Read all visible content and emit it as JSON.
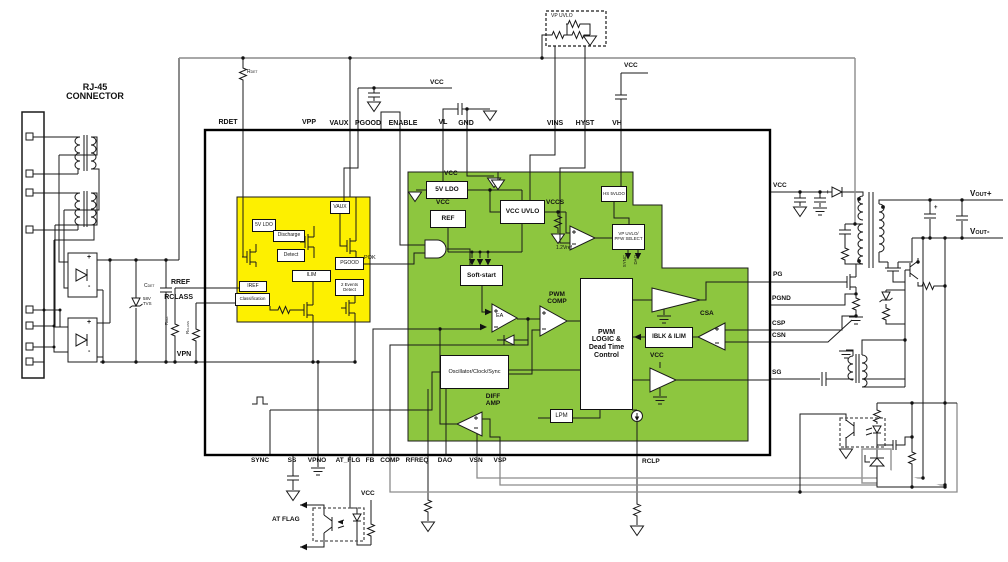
{
  "sym": {
    "plus": "+",
    "minus": "-"
  },
  "colors": {
    "yellow": "#fdf000",
    "green": "#8dc63f",
    "wire": "#1a1a1a",
    "gray_net": "#8c8c8c"
  },
  "rj45": {
    "line1": "RJ-45",
    "line2": "CONNECTOR"
  },
  "parts": {
    "rdet": {
      "base": "R",
      "sub": "DET"
    },
    "cdet": {
      "base": "C",
      "sub": "DET"
    },
    "tvs": {
      "line1": "58V",
      "line2": "TVS"
    },
    "rref": {
      "base": "R",
      "sub": "REF"
    },
    "rclass": {
      "base": "R",
      "sub": "CLASS"
    }
  },
  "nets": {
    "rref": "RREF",
    "rclass": "RCLASS",
    "vpn": "VPN",
    "pok": "POK",
    "vcc": "VCC",
    "vp_uvlo": "VP UVLO",
    "at_flag": "AT FLAG"
  },
  "ic": {
    "top_pins": [
      "RDET",
      "VPP",
      "VAUX",
      "PGOOD",
      "ENABLE",
      "VL",
      "GND",
      "VINS",
      "HYST",
      "VH"
    ],
    "bottom_pins": [
      "SYNC",
      "SS",
      "VPNO",
      "AT_FLG",
      "FB",
      "COMP",
      "RFREQ",
      "DAO",
      "VSN",
      "VSP"
    ],
    "right_pins": [
      "VCC",
      "PG",
      "PGND",
      "CSP",
      "CSN",
      "SG"
    ],
    "corner_pin": "RCLP"
  },
  "yellow": {
    "vaux": "VAUX",
    "ldo5": "5V LDO",
    "discharge": "Discharge",
    "detect": "Detect",
    "pgood": "PGOOD",
    "ilim": "ILIM",
    "iref": "IREF",
    "classification": "Classification",
    "events": "2 Events Detect"
  },
  "green": {
    "ldo5": "5V LDO",
    "ref": "REF",
    "vcc_uvlo": "VCC UVLO",
    "vccs": "VCCS",
    "vref": "1.2Vref",
    "hs_ldo": "HS 5VLDO",
    "select": "VP UVLO/ PFW SELECT",
    "sync": "SYNC",
    "dao": "DAO",
    "softstart": "Soft-start",
    "ea": "EA",
    "pwm_comp": "PWM COMP",
    "logic": "PWM LOGIC & Dead Time Control",
    "osc": "Oscillator/Clock/Sync",
    "diff": "DIFF AMP",
    "lpm": "LPM",
    "csa": "CSA",
    "iblk": "IBLK & ILIM",
    "vcc": "VCC"
  },
  "output": {
    "vout_p": {
      "base": "V",
      "sub": "OUT",
      "suffix": "+"
    },
    "vout_m": {
      "base": "V",
      "sub": "OUT",
      "suffix": "-"
    }
  }
}
